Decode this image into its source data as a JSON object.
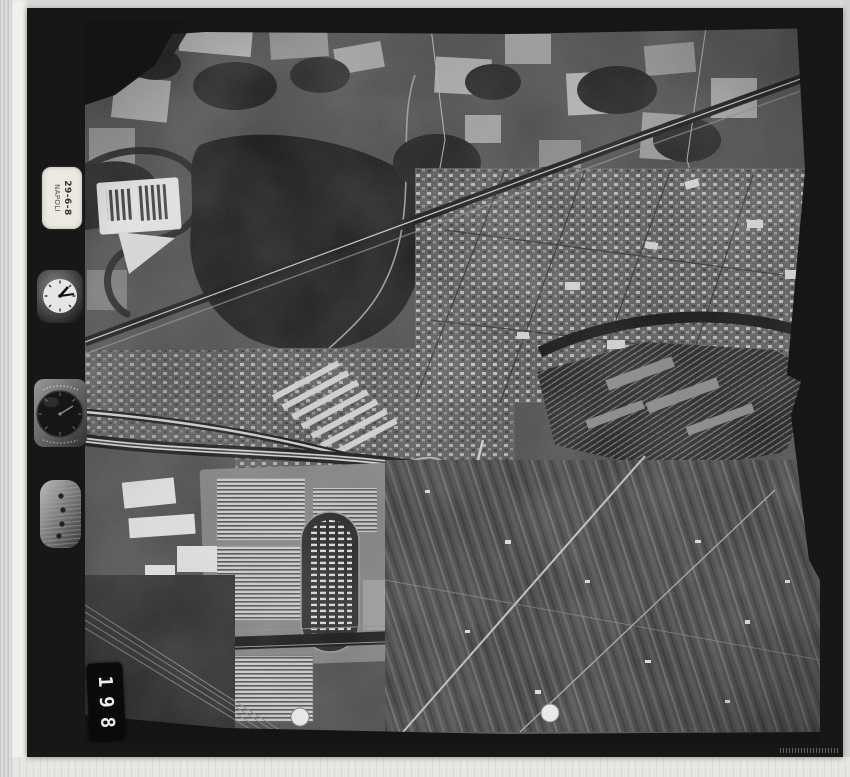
{
  "photo": {
    "film_label": {
      "line1": "29-6-8",
      "line2": "NAPOLI"
    },
    "frame_number": "198"
  },
  "icons": {
    "clock": "analog-clock-dial",
    "altimeter": "altimeter-dial",
    "level": "bubble-level-indicator"
  },
  "colors": {
    "scan_background": "#d8d8d8",
    "film_edge_black": "#171717",
    "label_paper": "#ece9e0",
    "photo_midtone": "#4a4a4a",
    "highlight_white": "#f2f2f2"
  }
}
